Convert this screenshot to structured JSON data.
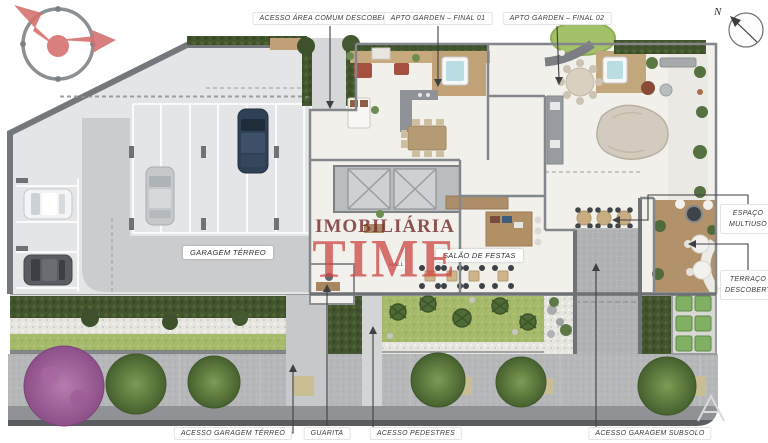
{
  "compass": {
    "north_label": "N"
  },
  "watermark": {
    "line1": "IMOBILIÁRIA",
    "line2": "TIME"
  },
  "callouts": {
    "top": [
      {
        "label": "ACESSO ÁREA COMUM DESCOBERTA"
      },
      {
        "label": "APTO GARDEN – FINAL 01"
      },
      {
        "label": "APTO GARDEN – FINAL 02"
      }
    ],
    "right": [
      {
        "label": "ESPAÇO MULTIUSO"
      },
      {
        "label": "TERRAÇO DESCOBERTO"
      }
    ],
    "bottom": [
      {
        "label": "ACESSO GARAGEM TÉRREO"
      },
      {
        "label": "GUARITA"
      },
      {
        "label": "ACESSO PEDESTRES"
      },
      {
        "label": "ACESSO GARAGEM SUBSOLO"
      }
    ]
  },
  "areas": {
    "garage": "GARAGEM TÉRREO",
    "party_room": "SALÃO DE FESTAS",
    "hall": "HALL"
  },
  "colors": {
    "watermark_red": "#cc4643",
    "watermark_dark_red": "#742e2d",
    "leader_line": "#3f4043",
    "label_text": "#3a3a3c",
    "hedge_green": "#42552e",
    "lawn_green": "#a6ba6c",
    "wood_deck": "#c4a77c",
    "garage_floor": "#e4e5e6",
    "drive_lane": "#c9cbcd",
    "street_gray": "#909294",
    "purple_tree": "#8d4f88"
  }
}
